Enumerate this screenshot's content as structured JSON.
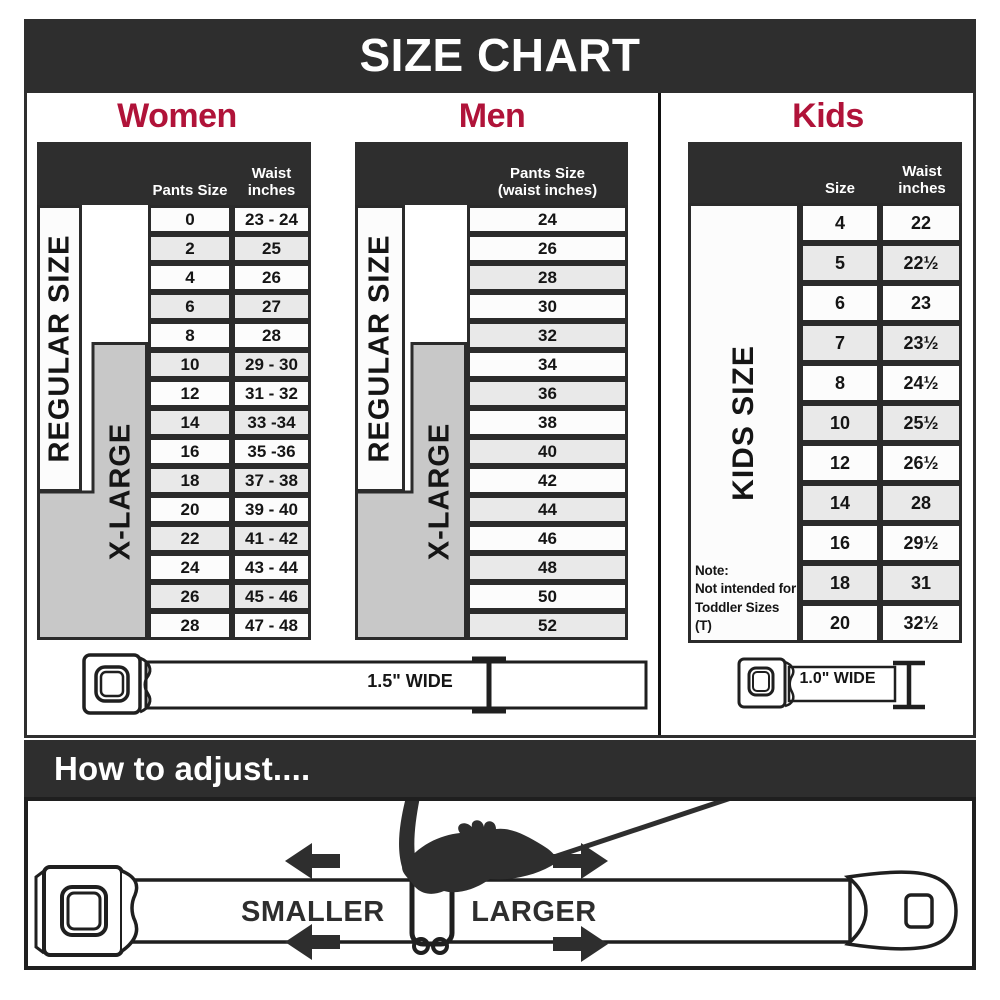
{
  "title": "SIZE CHART",
  "colors": {
    "charcoal": "#2e2e2e",
    "crimson": "#b01339",
    "row_shaded": "#e9e9e9",
    "row_plain": "#fcfcfc",
    "xlarge_gray": "#c8c8c8"
  },
  "women": {
    "heading": "Women",
    "size_col_header": "Pants Size",
    "waist_col_header": "Waist inches",
    "regular_label": "REGULAR SIZE",
    "xlarge_label": "X-LARGE",
    "belt_width_label": "1.5\" WIDE",
    "rows": [
      {
        "size": "0",
        "waist": "23 - 24",
        "shaded": false
      },
      {
        "size": "2",
        "waist": "25",
        "shaded": true
      },
      {
        "size": "4",
        "waist": "26",
        "shaded": false
      },
      {
        "size": "6",
        "waist": "27",
        "shaded": true
      },
      {
        "size": "8",
        "waist": "28",
        "shaded": false
      },
      {
        "size": "10",
        "waist": "29 - 30",
        "shaded": true
      },
      {
        "size": "12",
        "waist": "31 - 32",
        "shaded": false
      },
      {
        "size": "14",
        "waist": "33 -34",
        "shaded": true
      },
      {
        "size": "16",
        "waist": "35 -36",
        "shaded": false
      },
      {
        "size": "18",
        "waist": "37 - 38",
        "shaded": true
      },
      {
        "size": "20",
        "waist": "39 - 40",
        "shaded": false
      },
      {
        "size": "22",
        "waist": "41 - 42",
        "shaded": true
      },
      {
        "size": "24",
        "waist": "43 - 44",
        "shaded": false
      },
      {
        "size": "26",
        "waist": "45 - 46",
        "shaded": true
      },
      {
        "size": "28",
        "waist": "47 - 48",
        "shaded": false
      }
    ]
  },
  "men": {
    "heading": "Men",
    "col_header_line1": "Pants Size",
    "col_header_line2": "(waist inches)",
    "regular_label": "REGULAR SIZE",
    "xlarge_label": "X-LARGE",
    "rows": [
      {
        "size": "24",
        "shaded": false
      },
      {
        "size": "26",
        "shaded": false
      },
      {
        "size": "28",
        "shaded": true
      },
      {
        "size": "30",
        "shaded": false
      },
      {
        "size": "32",
        "shaded": true
      },
      {
        "size": "34",
        "shaded": false
      },
      {
        "size": "36",
        "shaded": true
      },
      {
        "size": "38",
        "shaded": false
      },
      {
        "size": "40",
        "shaded": true
      },
      {
        "size": "42",
        "shaded": false
      },
      {
        "size": "44",
        "shaded": true
      },
      {
        "size": "46",
        "shaded": false
      },
      {
        "size": "48",
        "shaded": true
      },
      {
        "size": "50",
        "shaded": false
      },
      {
        "size": "52",
        "shaded": true
      }
    ]
  },
  "kids": {
    "heading": "Kids",
    "size_col_header": "Size",
    "waist_col_header": "Waist inches",
    "kids_label": "KIDS SIZE",
    "note_line1": "Note:",
    "note_line2": "Not intended for",
    "note_line3": "Toddler Sizes (T)",
    "belt_width_label": "1.0\" WIDE",
    "rows": [
      {
        "size": "4",
        "waist": "22",
        "shaded": false
      },
      {
        "size": "5",
        "waist": "22½",
        "shaded": true
      },
      {
        "size": "6",
        "waist": "23",
        "shaded": false
      },
      {
        "size": "7",
        "waist": "23½",
        "shaded": true
      },
      {
        "size": "8",
        "waist": "24½",
        "shaded": false
      },
      {
        "size": "10",
        "waist": "25½",
        "shaded": true
      },
      {
        "size": "12",
        "waist": "26½",
        "shaded": false
      },
      {
        "size": "14",
        "waist": "28",
        "shaded": true
      },
      {
        "size": "16",
        "waist": "29½",
        "shaded": false
      },
      {
        "size": "18",
        "waist": "31",
        "shaded": true
      },
      {
        "size": "20",
        "waist": "32½",
        "shaded": false
      }
    ]
  },
  "adjust": {
    "heading": "How to adjust....",
    "smaller_label": "SMALLER",
    "larger_label": "LARGER"
  }
}
